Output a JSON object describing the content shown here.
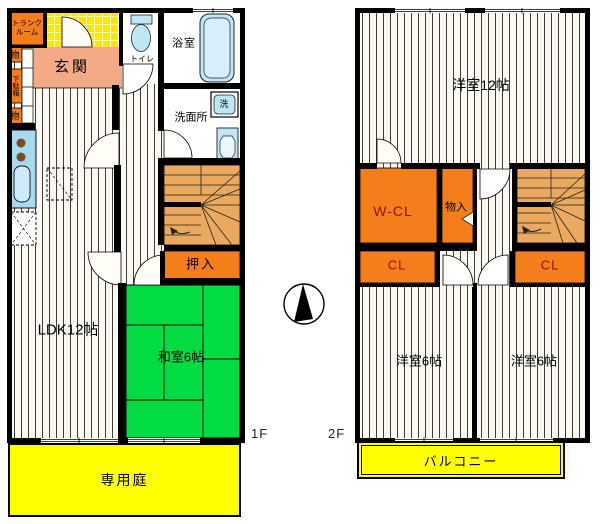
{
  "floor1": {
    "tag": "1F",
    "trunk_room_line1": "トランク",
    "trunk_room_line2": "ルーム",
    "storage_upper": "物",
    "shoe_cabinet": "下駄箱",
    "storage_lower": "物",
    "entrance": "玄関",
    "toilet": "トイレ",
    "bathroom": "浴室",
    "washroom": "洗面所",
    "washing_machine": "洗",
    "ldk": "LDK12帖",
    "japanese_room": "和室6帖",
    "oshiire_closet": "押入",
    "private_garden": "専用庭"
  },
  "floor2": {
    "tag": "2F",
    "western_room_12": "洋室12帖",
    "walk_in_closet": "W-CL",
    "storage": "物入",
    "closet_left": "CL",
    "closet_right": "CL",
    "western_room_6_left": "洋室6帖",
    "western_room_6_right": "洋室6帖",
    "balcony": "バルコニー"
  },
  "colors": {
    "wall": "#000000",
    "closet_orange": "#F57E1C",
    "entrance_salmon": "#F4AA87",
    "tatami_green": "#00DC41",
    "outdoor_yellow": "#FFFF00",
    "tile_yellow": "#FFE600",
    "stair_tan": "#EBA95F",
    "fixture_blue": "#BEE6F5",
    "closet_label_red": "#8B1500"
  }
}
